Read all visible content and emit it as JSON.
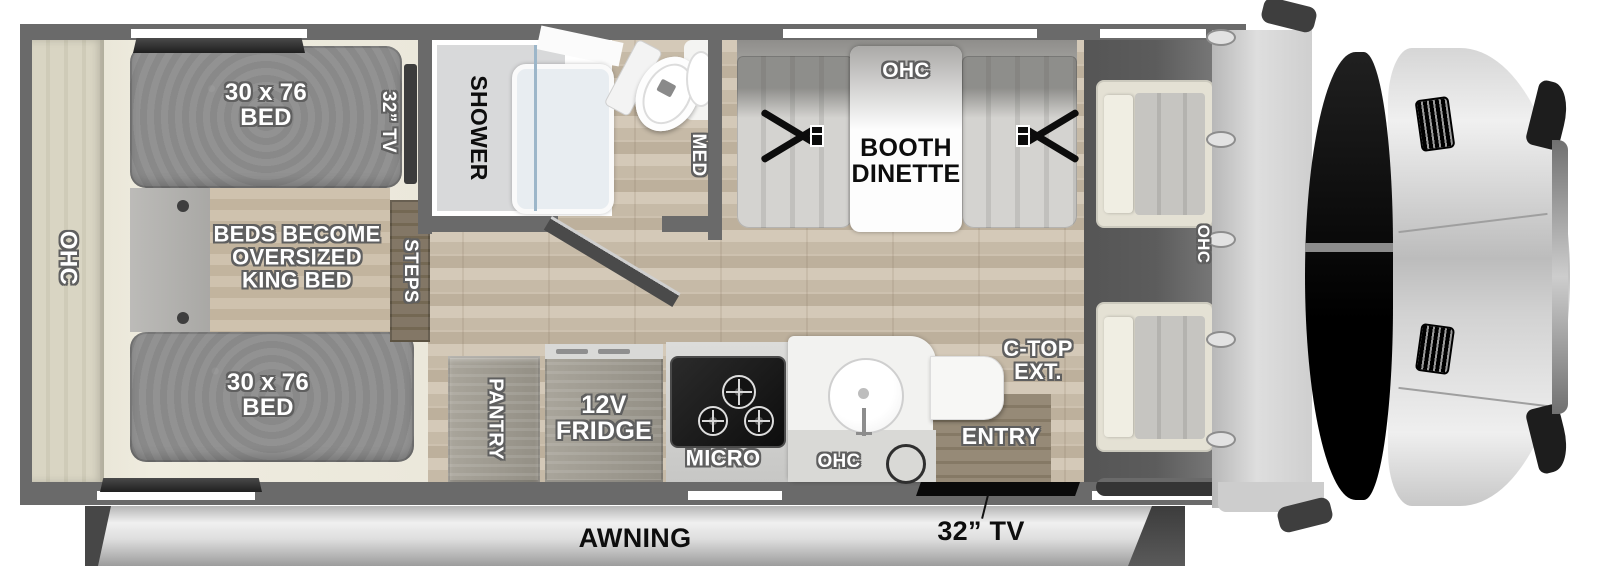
{
  "floorplan": {
    "rear": {
      "ohc": "OHC"
    },
    "bedroom": {
      "bed_top": "30 x 76\nBED",
      "bed_bottom": "30 x 76\nBED",
      "king_note": "BEDS BECOME\nOVERSIZED\nKING BED",
      "tv": "32” TV",
      "steps": "STEPS"
    },
    "bath": {
      "shower": "SHOWER",
      "med": "MED"
    },
    "dinette": {
      "ohc": "OHC",
      "booth": "BOOTH\nDINETTE"
    },
    "kitchen": {
      "pantry": "PANTRY",
      "fridge": "12V\nFRIDGE",
      "micro": "MICRO",
      "ohc": "OHC",
      "ctop_ext": "C-TOP\nEXT."
    },
    "entry": {
      "label": "ENTRY",
      "tv": "32” TV"
    },
    "cab": {
      "ohc": "OHC"
    },
    "awning": {
      "label": "AWNING"
    }
  },
  "colors": {
    "wall": "#6a6a6a",
    "bed": "#8f8f8f",
    "wood_floor": "#c8bcab",
    "bedroom_floor": "#ebe8dc",
    "cab_floor": "#575757",
    "label_white": "#ffffff",
    "label_outline": "#5f5f5f",
    "label_black": "#0d0d0d",
    "awning": "#d9d9d9"
  }
}
